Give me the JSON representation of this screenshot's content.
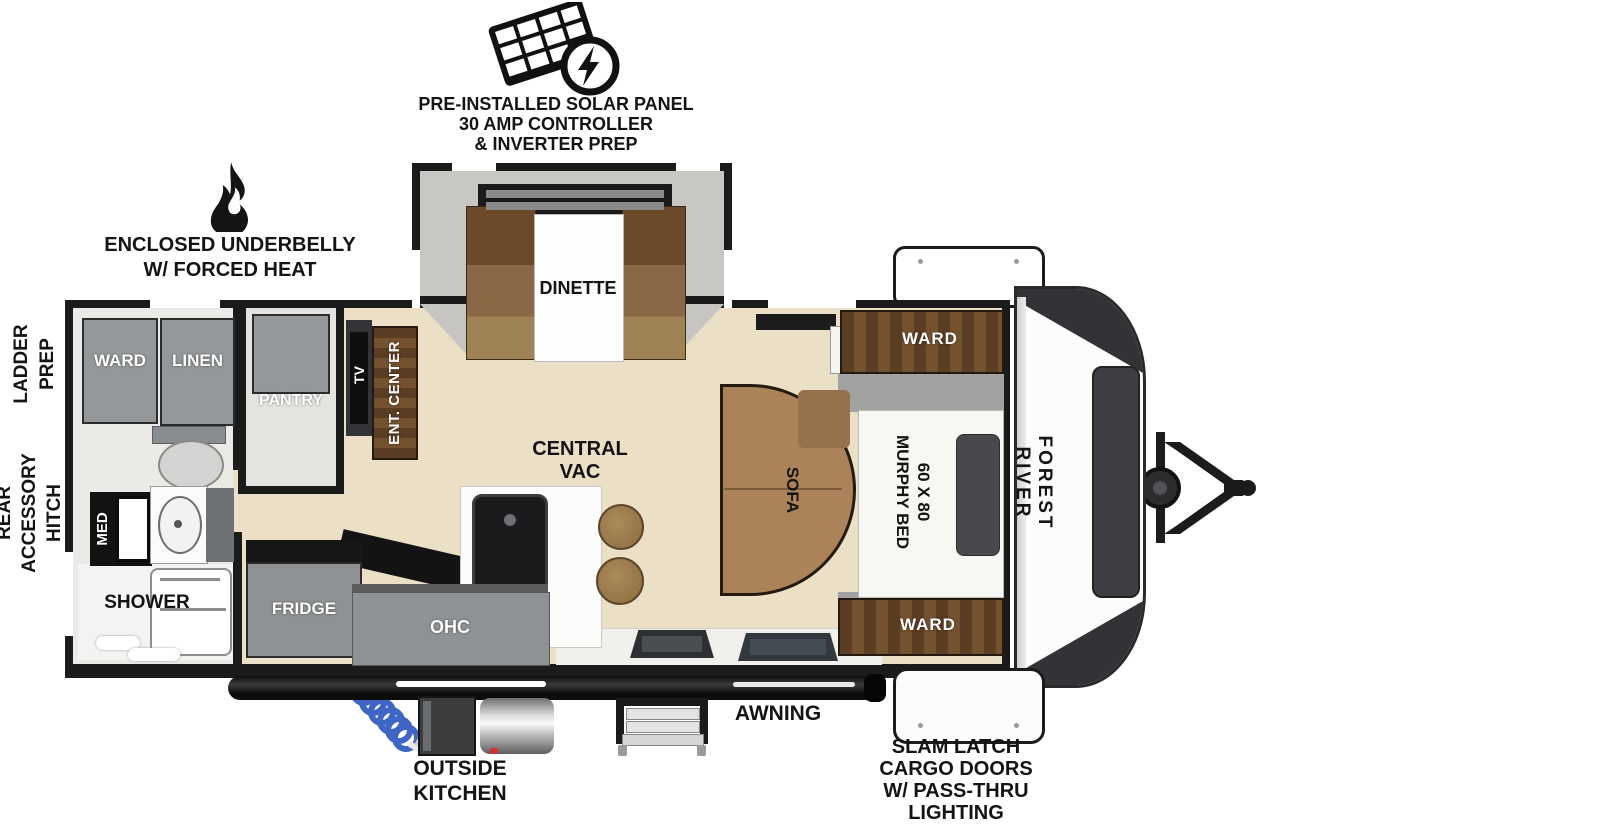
{
  "brand": "FOREST RIVER",
  "exterior_callouts": {
    "solar": {
      "icon": "solar-panel-icon",
      "lines": [
        "PRE-INSTALLED SOLAR PANEL",
        "30 AMP CONTROLLER",
        "& INVERTER PREP"
      ]
    },
    "underbelly": {
      "icon": "flame-icon",
      "lines": [
        "ENCLOSED UNDERBELLY",
        "W/ FORCED HEAT"
      ]
    },
    "ladder": {
      "lines": [
        "LADDER",
        "PREP"
      ]
    },
    "hitch": {
      "lines": [
        "REAR",
        "ACCESSORY",
        "HITCH"
      ]
    },
    "awning": "AWNING",
    "outside_kitchen": {
      "lines": [
        "OUTSIDE",
        "KITCHEN"
      ]
    },
    "cargo": {
      "lines": [
        "SLAM LATCH",
        "CARGO DOORS",
        "W/ PASS-THRU",
        "LIGHTING"
      ]
    }
  },
  "rooms": {
    "ward_rear": "WARD",
    "linen": "LINEN",
    "med": "MED",
    "shower": "SHOWER",
    "pantry": "PANTRY",
    "tv": "TV",
    "ent_center": "ENT. CENTER",
    "dinette": "DINETTE",
    "fridge": "FRIDGE",
    "ohc": "OHC",
    "central_vac": {
      "icon": "bootprint-icon",
      "lines": [
        "CENTRAL",
        "VAC"
      ]
    },
    "sofa": "SOFA",
    "murphy": {
      "lines": [
        "60 X 80",
        "MURPHY BED"
      ]
    },
    "ward_top": "WARD",
    "ward_bottom": "WARD"
  },
  "colors": {
    "wall": "#1b1b1b",
    "floor": "#ebdfc5",
    "cabinet_gray": "#95989a",
    "wood": "#6b4a2c",
    "sofa": "#ab8259",
    "slide_interior": "#c9c7c3",
    "accent_hose": "#3f66c4",
    "text": "#141414"
  }
}
